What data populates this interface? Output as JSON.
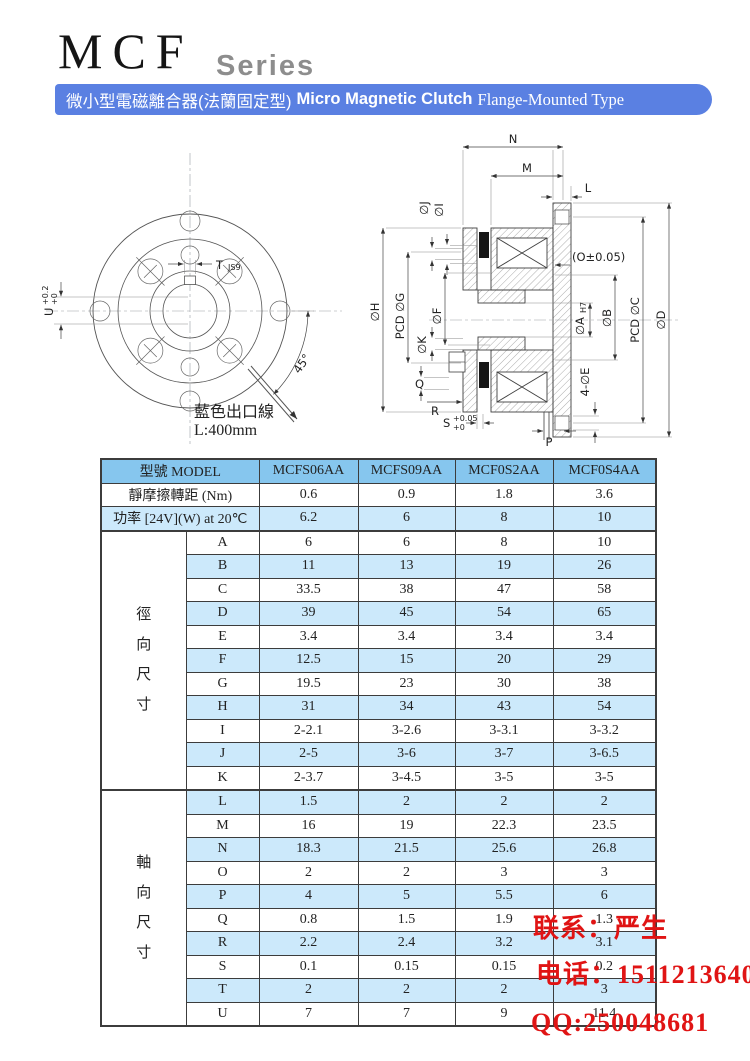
{
  "page": {
    "title": "MCF",
    "series": "Series"
  },
  "banner": {
    "zh": "微小型電磁離合器(法蘭固定型)",
    "en_bold": "Micro Magnetic Clutch",
    "en_tail": "Flange-Mounted Type"
  },
  "colors": {
    "banner_blue": "#5a80e2",
    "table_header_blue": "#86c6ee",
    "table_row_light_blue": "#cce9fb",
    "contact_red": "#e01414"
  },
  "front_view": {
    "t_label": "T",
    "t_fit": "JS9",
    "u_label": "U",
    "u_tol_top": "+0.2",
    "u_tol_bot": "+0",
    "angle_label": "45°",
    "wire_note_line1": "藍色出口線",
    "wire_note_line2": "L:400mm"
  },
  "section_view": {
    "n": "N",
    "m": "M",
    "l": "L",
    "dia_j": "∅J",
    "dia_i": "∅I",
    "dia_h": "∅H",
    "pcd_g": "PCD ∅G",
    "dia_f": "∅F",
    "dia_k": "∅K",
    "q": "Q",
    "r": "R",
    "s_label": "S",
    "s_tol_top": "+0.05",
    "s_tol_bot": "+0",
    "p": "P",
    "o_note": "(O±0.05)",
    "dia_a": "∅A",
    "a_fit": "H7",
    "dia_b": "∅B",
    "pcd_c": "PCD ∅C",
    "dia_d": "∅D",
    "e_note": "4-∅E"
  },
  "table": {
    "model_header": "型號  MODEL",
    "models": [
      "MCFS06AA",
      "MCFS09AA",
      "MCF0S2AA",
      "MCF0S4AA"
    ],
    "spec_rows": [
      {
        "label": "靜摩擦轉距  (Nm)",
        "values": [
          "0.6",
          "0.9",
          "1.8",
          "3.6"
        ]
      },
      {
        "label": "功率  [24V](W) at 20℃",
        "values": [
          "6.2",
          "6",
          "8",
          "10"
        ]
      }
    ],
    "groups": [
      {
        "label": "徑向尺寸",
        "rows": [
          {
            "dim": "A",
            "values": [
              "6",
              "6",
              "8",
              "10"
            ]
          },
          {
            "dim": "B",
            "values": [
              "11",
              "13",
              "19",
              "26"
            ]
          },
          {
            "dim": "C",
            "values": [
              "33.5",
              "38",
              "47",
              "58"
            ]
          },
          {
            "dim": "D",
            "values": [
              "39",
              "45",
              "54",
              "65"
            ]
          },
          {
            "dim": "E",
            "values": [
              "3.4",
              "3.4",
              "3.4",
              "3.4"
            ]
          },
          {
            "dim": "F",
            "values": [
              "12.5",
              "15",
              "20",
              "29"
            ]
          },
          {
            "dim": "G",
            "values": [
              "19.5",
              "23",
              "30",
              "38"
            ]
          },
          {
            "dim": "H",
            "values": [
              "31",
              "34",
              "43",
              "54"
            ]
          },
          {
            "dim": "I",
            "values": [
              "2-2.1",
              "3-2.6",
              "3-3.1",
              "3-3.2"
            ]
          },
          {
            "dim": "J",
            "values": [
              "2-5",
              "3-6",
              "3-7",
              "3-6.5"
            ]
          },
          {
            "dim": "K",
            "values": [
              "2-3.7",
              "3-4.5",
              "3-5",
              "3-5"
            ]
          }
        ]
      },
      {
        "label": "軸向尺寸",
        "rows": [
          {
            "dim": "L",
            "values": [
              "1.5",
              "2",
              "2",
              "2"
            ]
          },
          {
            "dim": "M",
            "values": [
              "16",
              "19",
              "22.3",
              "23.5"
            ]
          },
          {
            "dim": "N",
            "values": [
              "18.3",
              "21.5",
              "25.6",
              "26.8"
            ]
          },
          {
            "dim": "O",
            "values": [
              "2",
              "2",
              "3",
              "3"
            ]
          },
          {
            "dim": "P",
            "values": [
              "4",
              "5",
              "5.5",
              "6"
            ]
          },
          {
            "dim": "Q",
            "values": [
              "0.8",
              "1.5",
              "1.9",
              "1.3"
            ]
          },
          {
            "dim": "R",
            "values": [
              "2.2",
              "2.4",
              "3.2",
              "3.1"
            ]
          },
          {
            "dim": "S",
            "values": [
              "0.1",
              "0.15",
              "0.15",
              "0.2"
            ]
          },
          {
            "dim": "T",
            "values": [
              "2",
              "2",
              "2",
              "3"
            ]
          },
          {
            "dim": "U",
            "values": [
              "7",
              "7",
              "9",
              "11.4"
            ]
          }
        ]
      }
    ]
  },
  "contact": {
    "line1": "联系：严生",
    "line2": "电话：15112136402",
    "line3": "QQ:250048681"
  }
}
